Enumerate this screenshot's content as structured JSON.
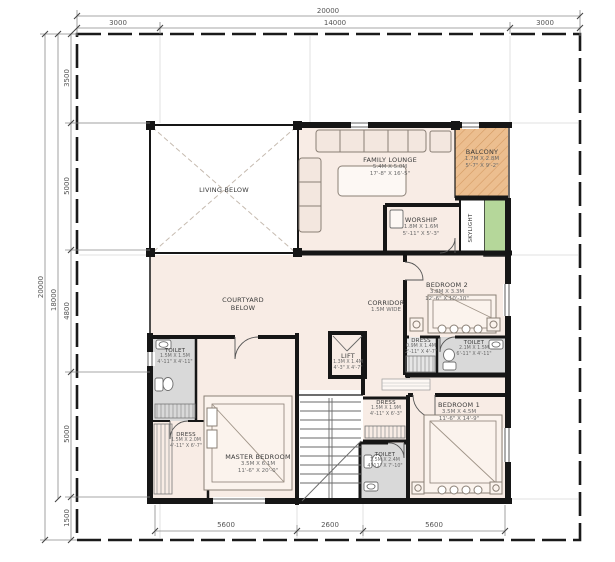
{
  "dimensions": {
    "top_total": "20000",
    "top_segments": [
      "3000",
      "14000",
      "3000"
    ],
    "left_outer": "20000",
    "left_inner": "18000",
    "left_segments": [
      "3500",
      "5000",
      "4800",
      "5000",
      "1500"
    ],
    "bottom_segments": [
      "5600",
      "2600",
      "5600"
    ]
  },
  "rooms": {
    "living": {
      "name": "LIVING BELOW"
    },
    "family_lounge": {
      "name": "FAMILY LOUNGE",
      "size_m": "5.4M X 5.0M",
      "size_ft": "17'-8\" X 16'-5\""
    },
    "balcony": {
      "name": "BALCONY",
      "size_m": "1.7M X 2.8M",
      "size_ft": "5'-7\" X 9'-2\""
    },
    "worship": {
      "name": "WORSHIP",
      "size_m": "1.8M X 1.6M",
      "size_ft": "5'-11\" X 5'-3\""
    },
    "skylight": {
      "name": "SKYLIGHT"
    },
    "courtyard": {
      "line1": "COURTYARD",
      "line2": "BELOW"
    },
    "corridor": {
      "name": "CORRIDOR",
      "size": "1.5M WIDE"
    },
    "bedroom2": {
      "name": "BEDROOM 2",
      "size_m": "3.8M X 3.3M",
      "size_ft": "12'-6\" X 10'-10\""
    },
    "dress2": {
      "name": "DRESS",
      "size_m": "0.9M X 1.4M",
      "size_ft": "2'-11\" X 4'-7\""
    },
    "toilet2": {
      "name": "TOILET",
      "size_m": "2.1M X 1.5M",
      "size_ft": "6'-11\" X 4'-11\""
    },
    "lift": {
      "name": "LIFT",
      "size_m": "1.3M X 1.4M",
      "size_ft": "4'-3\" X 4'-7\""
    },
    "toilet_master": {
      "name": "TOILET",
      "size_m": "1.5M X 1.5M",
      "size_ft": "4'-11\" X 4'-11\""
    },
    "dress_master": {
      "name": "DRESS",
      "size_m": "1.5M X 2.0M",
      "size_ft": "4'-11\" X 6'-7\""
    },
    "master_bedroom": {
      "name": "MASTER BEDROOM",
      "size_m": "3.5M X 6.1M",
      "size_ft": "11'-6\" X 20'-0\""
    },
    "dress1": {
      "name": "DRESS",
      "size_m": "1.5M X 1.9M",
      "size_ft": "4'-11\" X 6'-3\""
    },
    "toilet1": {
      "name": "TOILET",
      "size_m": "1.5M X 2.4M",
      "size_ft": "4'-11\" X 7'-10\""
    },
    "bedroom1": {
      "name": "BEDROOM 1",
      "size_m": "3.5M X 4.5M",
      "size_ft": "11'-6\" X 14'-9\""
    }
  },
  "colors": {
    "floor": "#f8ece5",
    "balcony": "#ecbe8f",
    "skylight_green": "#b5d79a",
    "toilet_floor": "#d9d9d9",
    "wall": "#161616",
    "dim_line": "#8a8a8a"
  }
}
